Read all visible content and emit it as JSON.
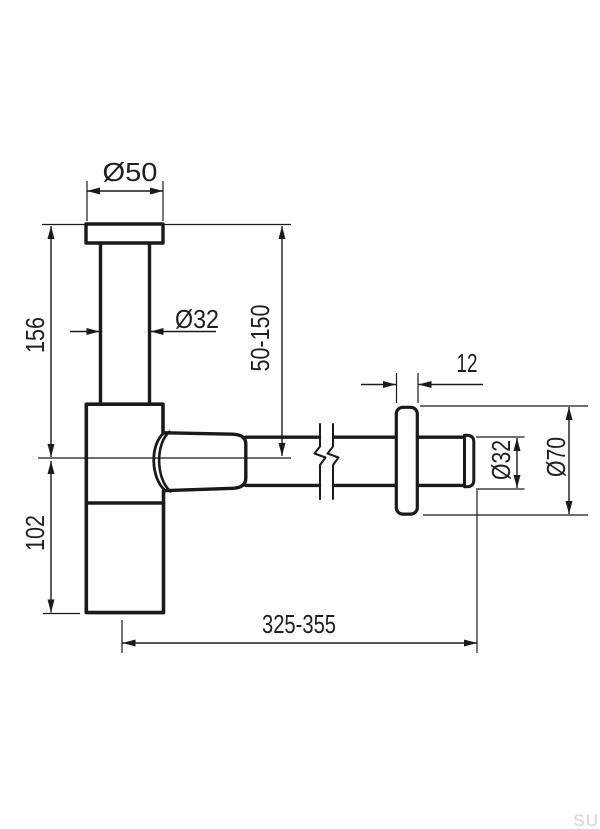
{
  "drawing": {
    "dimensions": {
      "top_flange_diameter": "Ø50",
      "inlet_pipe_diameter": "Ø32",
      "inlet_height_range": "50-150",
      "body_height": "156",
      "cup_height": "102",
      "rosette_thickness": "12",
      "outlet_pipe_diameter": "Ø32",
      "rosette_diameter": "Ø70",
      "outlet_length_range": "325-355"
    },
    "watermark": "SU",
    "colors": {
      "line": "#1a1a1a",
      "watermark": "#d2d2d2",
      "background": "#ffffff"
    }
  }
}
